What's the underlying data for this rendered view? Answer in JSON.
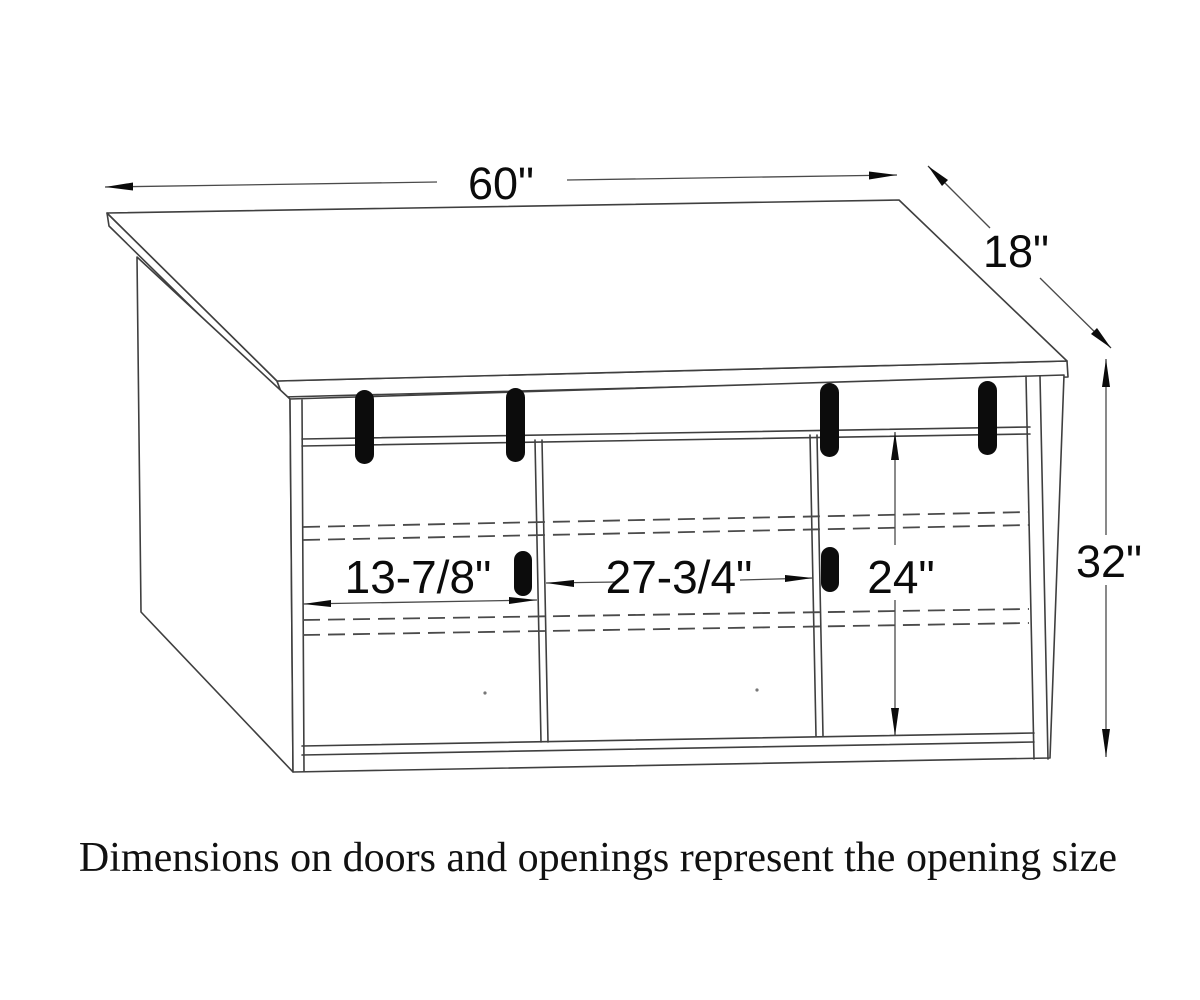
{
  "drawing": {
    "title": "cabinet-technical-drawing",
    "background_color": "#ffffff",
    "line_color": "#3f3f3f",
    "handle_color": "#0c0c0c",
    "text_color": "#0b0b0b",
    "dimensions": {
      "top_width": "60\"",
      "top_depth": "18\"",
      "cabinet_height": "32\"",
      "opening_height": "24\"",
      "left_opening_width": "13-7/8\"",
      "center_opening_width": "27-3/4\""
    },
    "caption": "Dimensions on doors and openings represent the opening size"
  }
}
